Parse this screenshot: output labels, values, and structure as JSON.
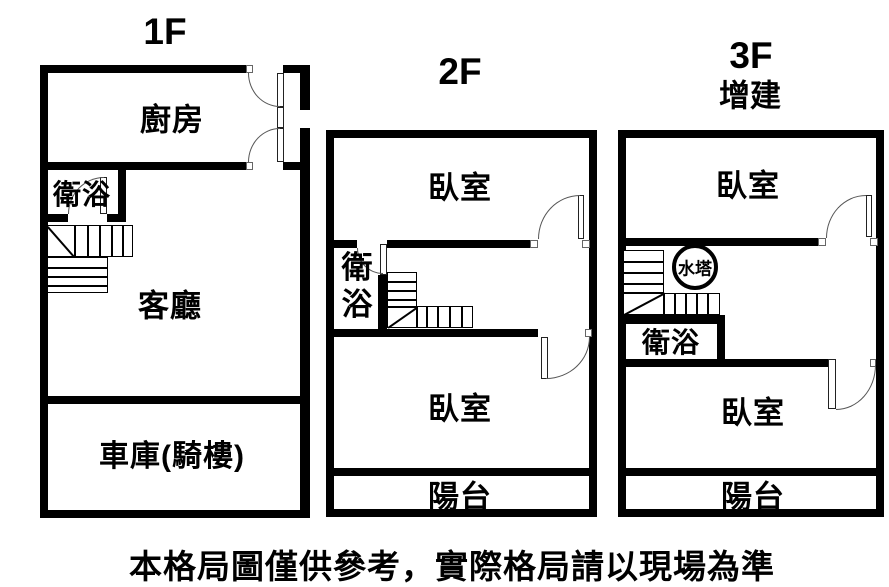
{
  "colors": {
    "wall": "#000000",
    "background": "#ffffff",
    "line": "#000000",
    "text": "#000000"
  },
  "floors": [
    {
      "title": "1F",
      "kitchen": "廚房",
      "bath": "衛浴",
      "living": "客廳",
      "garage": "車庫(騎樓)"
    },
    {
      "title": "2F",
      "bedroom_top": "臥室",
      "bath": "衛浴",
      "bedroom_bottom": "臥室",
      "balcony": "陽台"
    },
    {
      "title": "3F",
      "subtitle": "增建",
      "bedroom_top": "臥室",
      "water_tank": "水塔",
      "bath": "衛浴",
      "bedroom_bottom": "臥室",
      "balcony": "陽台"
    }
  ],
  "disclaimer": "本格局圖僅供參考，實際格局請以現場為準"
}
